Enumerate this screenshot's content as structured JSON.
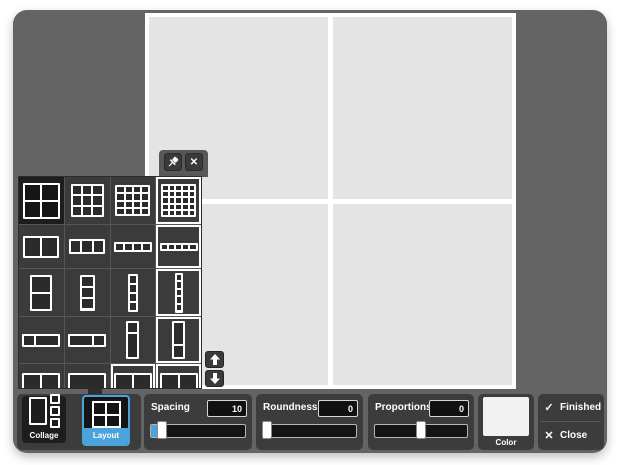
{
  "canvas": {
    "rows": 2,
    "cols": 2,
    "cell_color": "#e4e4e4",
    "frame_color": "#ffffff"
  },
  "panel": {
    "pin_icon": "pushpin",
    "close_icon": "x",
    "scroll_up_icon": "arrow-up",
    "scroll_down_icon": "arrow-down",
    "cells": [
      {
        "kind": "grid",
        "cols": 2,
        "rows": 2,
        "w": 37,
        "h": 36,
        "state": "selected"
      },
      {
        "kind": "grid",
        "cols": 3,
        "rows": 3,
        "w": 33,
        "h": 33,
        "state": "normal"
      },
      {
        "kind": "grid",
        "cols": 4,
        "rows": 4,
        "w": 35,
        "h": 31,
        "state": "normal"
      },
      {
        "kind": "grid",
        "cols": 5,
        "rows": 5,
        "w": 35,
        "h": 33,
        "state": "outlined"
      },
      {
        "kind": "grid",
        "cols": 2,
        "rows": 1,
        "w": 36,
        "h": 22,
        "state": "normal"
      },
      {
        "kind": "grid",
        "cols": 3,
        "rows": 1,
        "w": 36,
        "h": 15,
        "state": "normal"
      },
      {
        "kind": "grid",
        "cols": 4,
        "rows": 1,
        "w": 38,
        "h": 10,
        "state": "normal"
      },
      {
        "kind": "grid",
        "cols": 5,
        "rows": 1,
        "w": 38,
        "h": 8,
        "state": "outlined"
      },
      {
        "kind": "grid",
        "cols": 1,
        "rows": 2,
        "w": 22,
        "h": 36,
        "state": "normal"
      },
      {
        "kind": "grid",
        "cols": 1,
        "rows": 3,
        "w": 15,
        "h": 36,
        "state": "normal"
      },
      {
        "kind": "grid",
        "cols": 1,
        "rows": 4,
        "w": 10,
        "h": 38,
        "state": "normal"
      },
      {
        "kind": "grid",
        "cols": 1,
        "rows": 5,
        "w": 8,
        "h": 40,
        "state": "outlined"
      },
      {
        "kind": "hsplit",
        "weights": [
          1,
          2.2
        ],
        "w": 38,
        "h": 13,
        "state": "normal"
      },
      {
        "kind": "hsplit",
        "weights": [
          2.2,
          1
        ],
        "w": 38,
        "h": 13,
        "state": "normal"
      },
      {
        "kind": "vsplit",
        "weights": [
          1,
          2.6
        ],
        "w": 13,
        "h": 38,
        "state": "normal"
      },
      {
        "kind": "vsplit",
        "weights": [
          1.8,
          1
        ],
        "w": 13,
        "h": 38,
        "state": "outlined"
      },
      {
        "kind": "strip",
        "top_cols": 2,
        "w": 38,
        "h": 27,
        "state": "normal"
      },
      {
        "kind": "strip",
        "top_cols": 1,
        "w": 38,
        "h": 27,
        "state": "normal"
      },
      {
        "kind": "strip",
        "top_cols": 2,
        "w": 38,
        "h": 27,
        "state": "outlined"
      },
      {
        "kind": "strip",
        "top_cols": 2,
        "w": 38,
        "h": 27,
        "state": "outlined"
      }
    ]
  },
  "toolbar": {
    "collage_label": "Collage",
    "layout_label": "Layout",
    "accent_color": "#4aa3d9",
    "spacing": {
      "label": "Spacing",
      "value": "10",
      "handle_pct": 7,
      "fill_pct": 10
    },
    "roundness": {
      "label": "Roundness",
      "value": "0",
      "handle_pct": 0,
      "fill_pct": 0
    },
    "proportions": {
      "label": "Proportions",
      "value": "0",
      "handle_pct": 45,
      "fill_pct": 0
    },
    "color_label": "Color",
    "finished_glyph": "✓",
    "finished_label": "Finished",
    "close_glyph": "✕",
    "close_label": "Close"
  }
}
